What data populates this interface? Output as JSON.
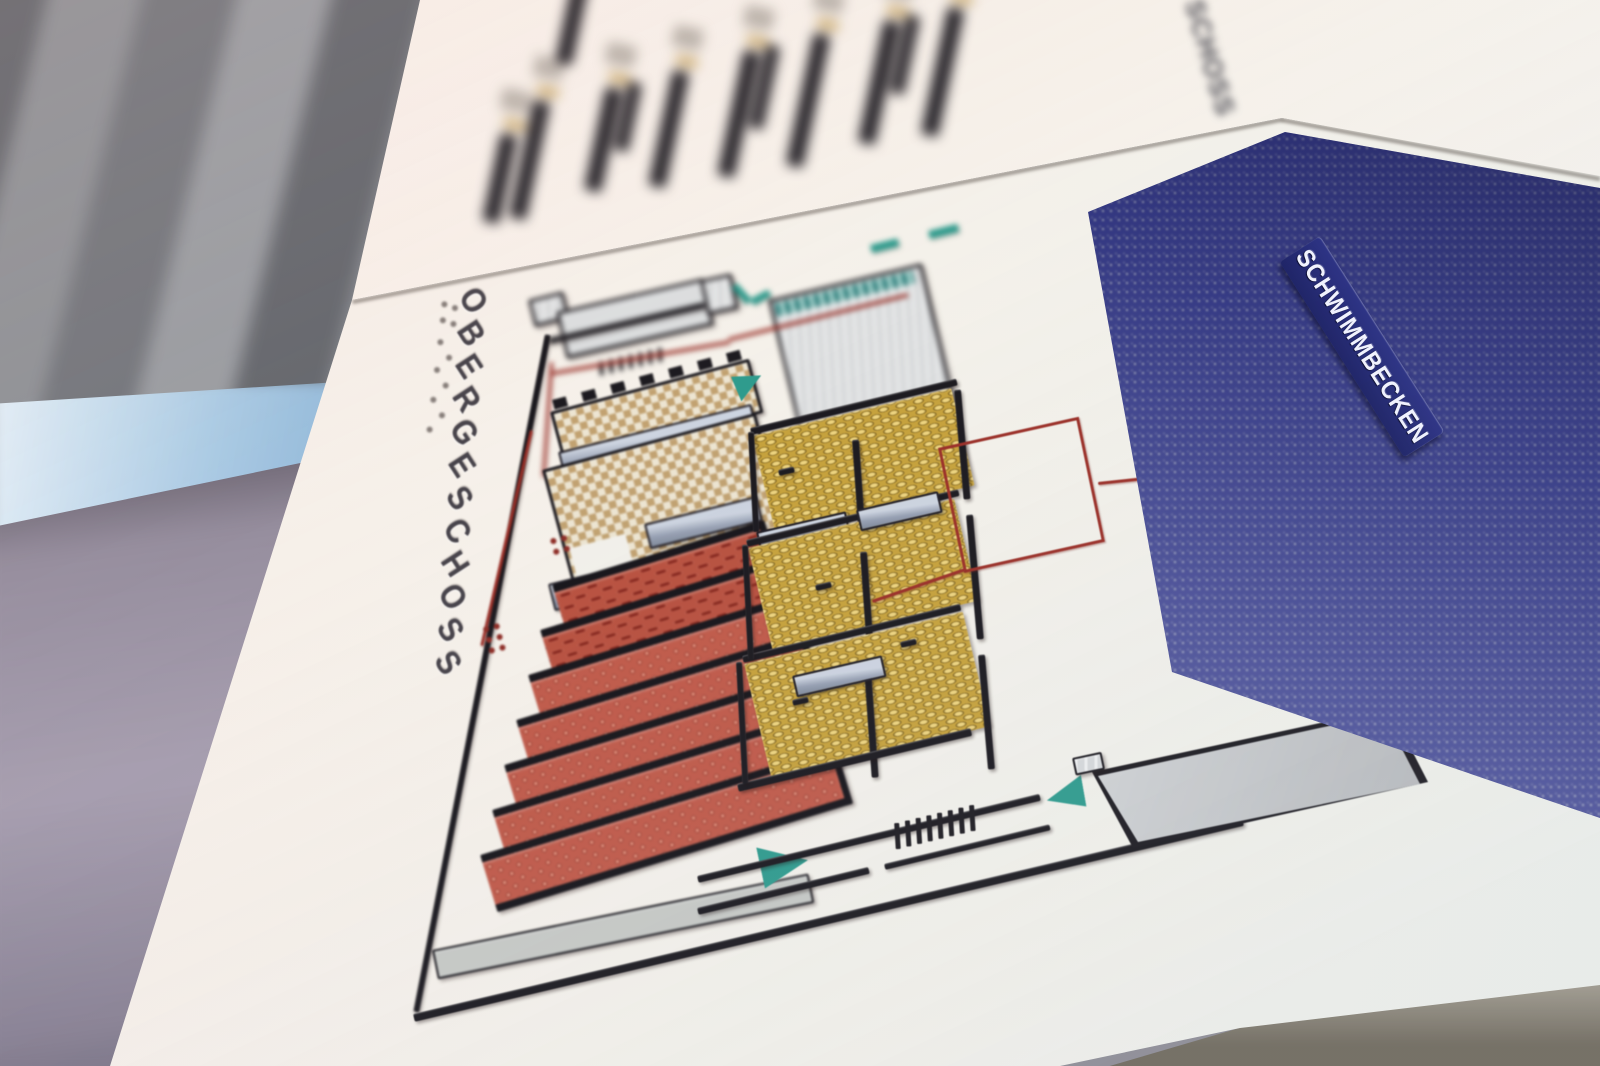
{
  "photo": {
    "description": "Tactile (braille) floor-plan sign photographed at an angle in a building, background strongly out of focus"
  },
  "board": {
    "floor_title": "OBERGESCHOSS",
    "adjacent_panel_title_fragment": "SCHOSS",
    "legend": {
      "item_count": 9,
      "labels_legible": false,
      "swatch_color": "#c9a96b"
    },
    "plan": {
      "pool_label": "SCHWIMMBECKEN",
      "has_braille_labels": true,
      "room_colors": {
        "pool_blue": "#3a3f8e",
        "rooms_red": "#bb5244",
        "rooms_yellow": "#c7a23b",
        "rooms_tan": "#c9ac7a",
        "rooms_gray": "#d0d2d4",
        "walls_black": "#1b191e",
        "guide_line_red": "#9b2f27",
        "marker_teal": "#2f9b8d"
      }
    }
  }
}
